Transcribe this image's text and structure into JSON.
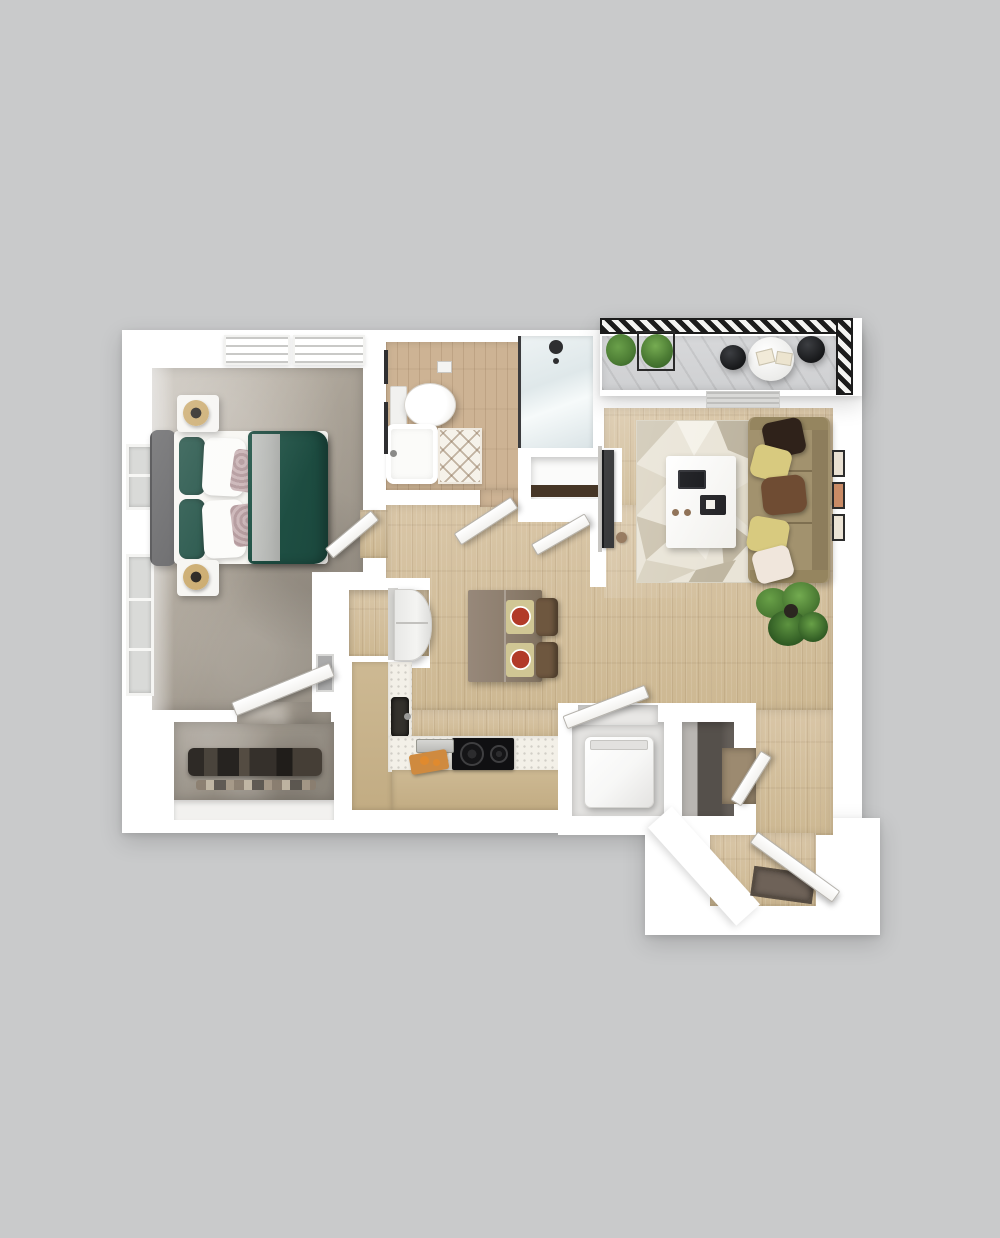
{
  "meta": {
    "image_type": "3d-top-down-floor-plan",
    "visible_text": [],
    "unit_summary": "one-bedroom one-bath apartment with balcony"
  },
  "palette": {
    "bg": "#c9cacb",
    "wall": "#ffffff",
    "wood": "#d9c6a7",
    "woodDark": "#cdb892",
    "bathWood": "#cdb394",
    "balconyFloor": "#d7d8da",
    "carpet": "#b1a99d",
    "carpetDark": "#a39b8f",
    "green": "#215548",
    "greenDark": "#1e4f43",
    "headboard": "#5f5f61",
    "grayThrow": "#b6b8b5",
    "sofa": "#a2926e",
    "sofaDark": "#8d7d5c",
    "pillowBrownDark": "#2f221a",
    "pillowYellow": "#d8ca7f",
    "pillowBrown": "#6f4c33",
    "pillowCream": "#f0e6dc",
    "tableBrown": "#8e7f6f",
    "chairBrown": "#6e573f",
    "matOlive": "#d0c694",
    "plateRed": "#b23a28",
    "cab": "#cdb993",
    "countertop": "#f3f0e8",
    "cooktop": "#101012",
    "steel": "#b9b9b6",
    "board": "#cf8a3f",
    "fridge": "#f4f4f2",
    "washer": "#f7f7f6",
    "closetDark": "#35302b",
    "frameDark": "#2c2c2c",
    "plantGreen": "#4c7c34",
    "plantDark": "#2f5a23",
    "soil": "#2b2620",
    "doormat": "#6e6258",
    "railing": "#1c1c1c",
    "tv": "#1a1b1d",
    "shelfWood": "#463626",
    "doorEdge": "#b5b2ac",
    "niche": "#fbfbfa"
  },
  "scene": {
    "rooms": [
      {
        "name": "bedroom",
        "floor": "gray carpet",
        "objects": [
          "queen-bed-green-duvet",
          "headboard",
          "nightstand-left-top",
          "nightstand-left-bottom",
          "lamp-gold-top",
          "lamp-gold-bottom",
          "ceiling-vent",
          "window-upper",
          "window-lower",
          "electrical-panel"
        ]
      },
      {
        "name": "walk-in-closet",
        "floor": "gray carpet",
        "objects": [
          "hanging-clothes",
          "shoe-row",
          "shelf"
        ]
      },
      {
        "name": "bathroom",
        "floor": "wood",
        "objects": [
          "toilet",
          "bathtub",
          "bath-mat-lattice",
          "glass-shower",
          "shower-head",
          "toilet-paper-holder",
          "towel-bars"
        ]
      },
      {
        "name": "hallway",
        "floor": "wood",
        "objects": [
          "bedroom-door",
          "bathroom-door",
          "linen-niche",
          "niche-door"
        ]
      },
      {
        "name": "kitchen",
        "floor": "wood",
        "objects": [
          "refrigerator-nook",
          "refrigerator",
          "l-shaped-counter",
          "sink",
          "cooktop",
          "toaster-tray",
          "cutting-board"
        ]
      },
      {
        "name": "dining",
        "floor": "wood",
        "objects": [
          "dining-table",
          "chair-1",
          "chair-2",
          "placemat-1",
          "placemat-2",
          "red-plate-1",
          "red-plate-2"
        ]
      },
      {
        "name": "living-room",
        "floor": "wood",
        "objects": [
          "geometric-rug",
          "coffee-table",
          "tablet",
          "tray",
          "sofa",
          "pillows-x5",
          "tv",
          "wall-frames-x3",
          "potted-plant",
          "ceiling-vent"
        ]
      },
      {
        "name": "laundry-closet",
        "floor": "",
        "objects": [
          "washer",
          "closet-door"
        ]
      },
      {
        "name": "coat-closet",
        "floor": "",
        "objects": [
          "mirror-interior",
          "closet-door"
        ]
      },
      {
        "name": "entry",
        "floor": "wood",
        "objects": [
          "entry-door",
          "doormat",
          "chamfered-wall"
        ]
      },
      {
        "name": "balcony",
        "floor": "gray plank",
        "objects": [
          "hatched-railing-top",
          "hatched-railing-right",
          "round-table",
          "cafe-chair-1",
          "cafe-chair-2",
          "planter-plants"
        ]
      }
    ]
  }
}
